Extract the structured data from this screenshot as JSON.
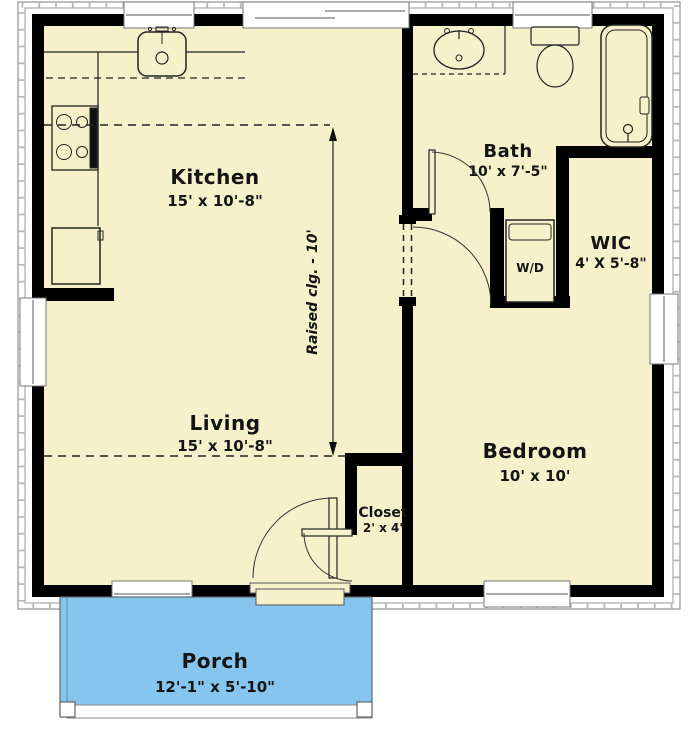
{
  "title": "Cottage Floor Plan",
  "colors": {
    "floor": "#F6F1CB",
    "porch": "#86C5EE",
    "wall": "#000000",
    "line": "#222222",
    "window": "#FFFFFF",
    "siding": "#9A9A9A"
  },
  "rooms": {
    "kitchen": {
      "name": "Kitchen",
      "dims": "15' x 10'-8\""
    },
    "living": {
      "name": "Living",
      "dims": "15' x 10'-8\""
    },
    "bath": {
      "name": "Bath",
      "dims": "10' x 7'-5\""
    },
    "wic": {
      "name": "WIC",
      "dims": "4' X 5'-8\""
    },
    "bedroom": {
      "name": "Bedroom",
      "dims": "10' x 10'"
    },
    "closet": {
      "name": "Closet",
      "dims": "2' x 4'"
    },
    "porch": {
      "name": "Porch",
      "dims": "12'-1\" x 5'-10\""
    }
  },
  "annotations": {
    "ceiling_note": "Raised clg. - 10'",
    "washer_dryer": "W/D"
  },
  "fixtures": [
    "kitchen-sink",
    "range",
    "refrigerator",
    "bath-vanity-sink",
    "toilet",
    "bathtub",
    "washer-dryer"
  ]
}
